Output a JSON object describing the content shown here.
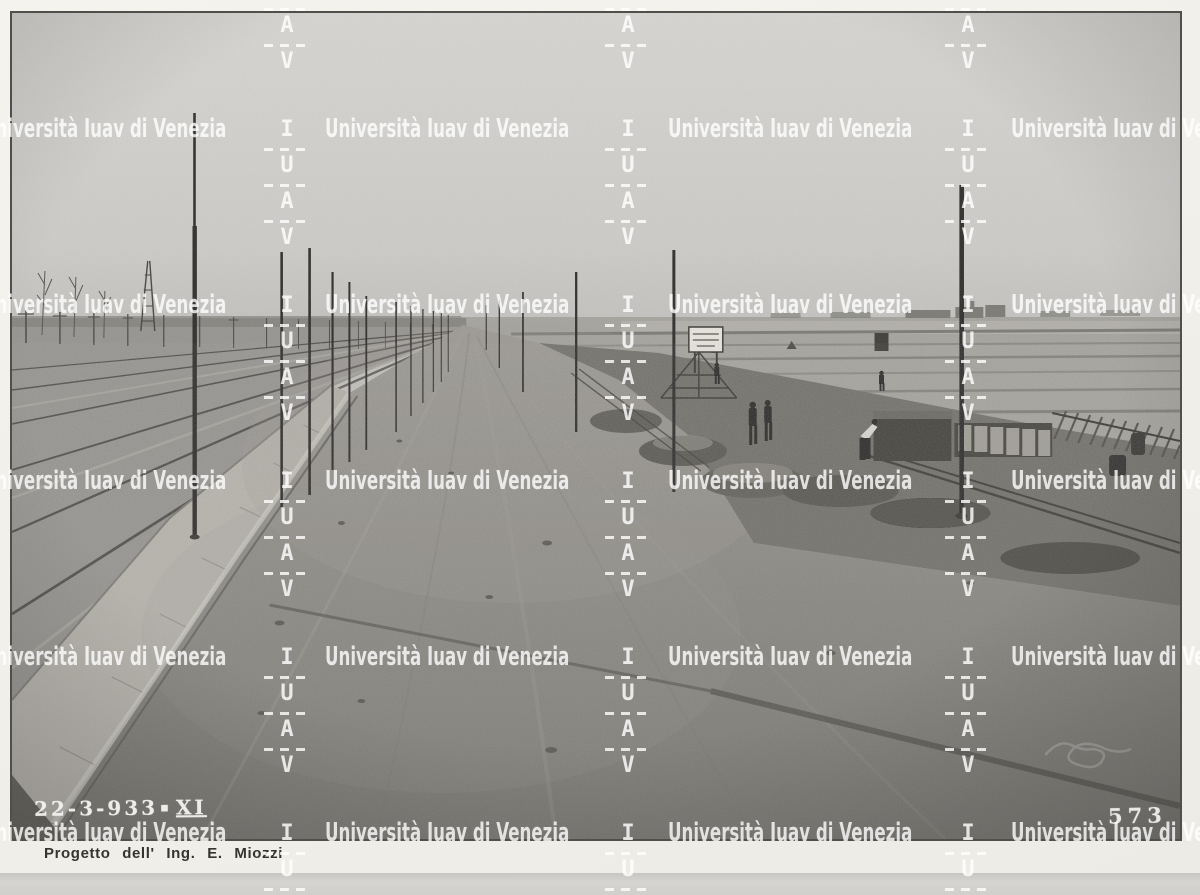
{
  "watermark": {
    "text": "Università Iuav di Venezia",
    "letters": [
      "I",
      "U",
      "A",
      "V"
    ],
    "color": "#ffffff"
  },
  "stamps": {
    "date_main": "22-3-933",
    "date_separator": "▪",
    "date_era": "XI",
    "archive_number": "573"
  },
  "caption": {
    "text": "Progetto dell' Ing. E. Miozzi"
  },
  "colors": {
    "sky": "#d3d2cf",
    "road": "#87857f",
    "mat": "#f2f0ea",
    "desk": "#d3d1ce",
    "photo_border": "#504f4a",
    "watermark": "#ffffff"
  }
}
